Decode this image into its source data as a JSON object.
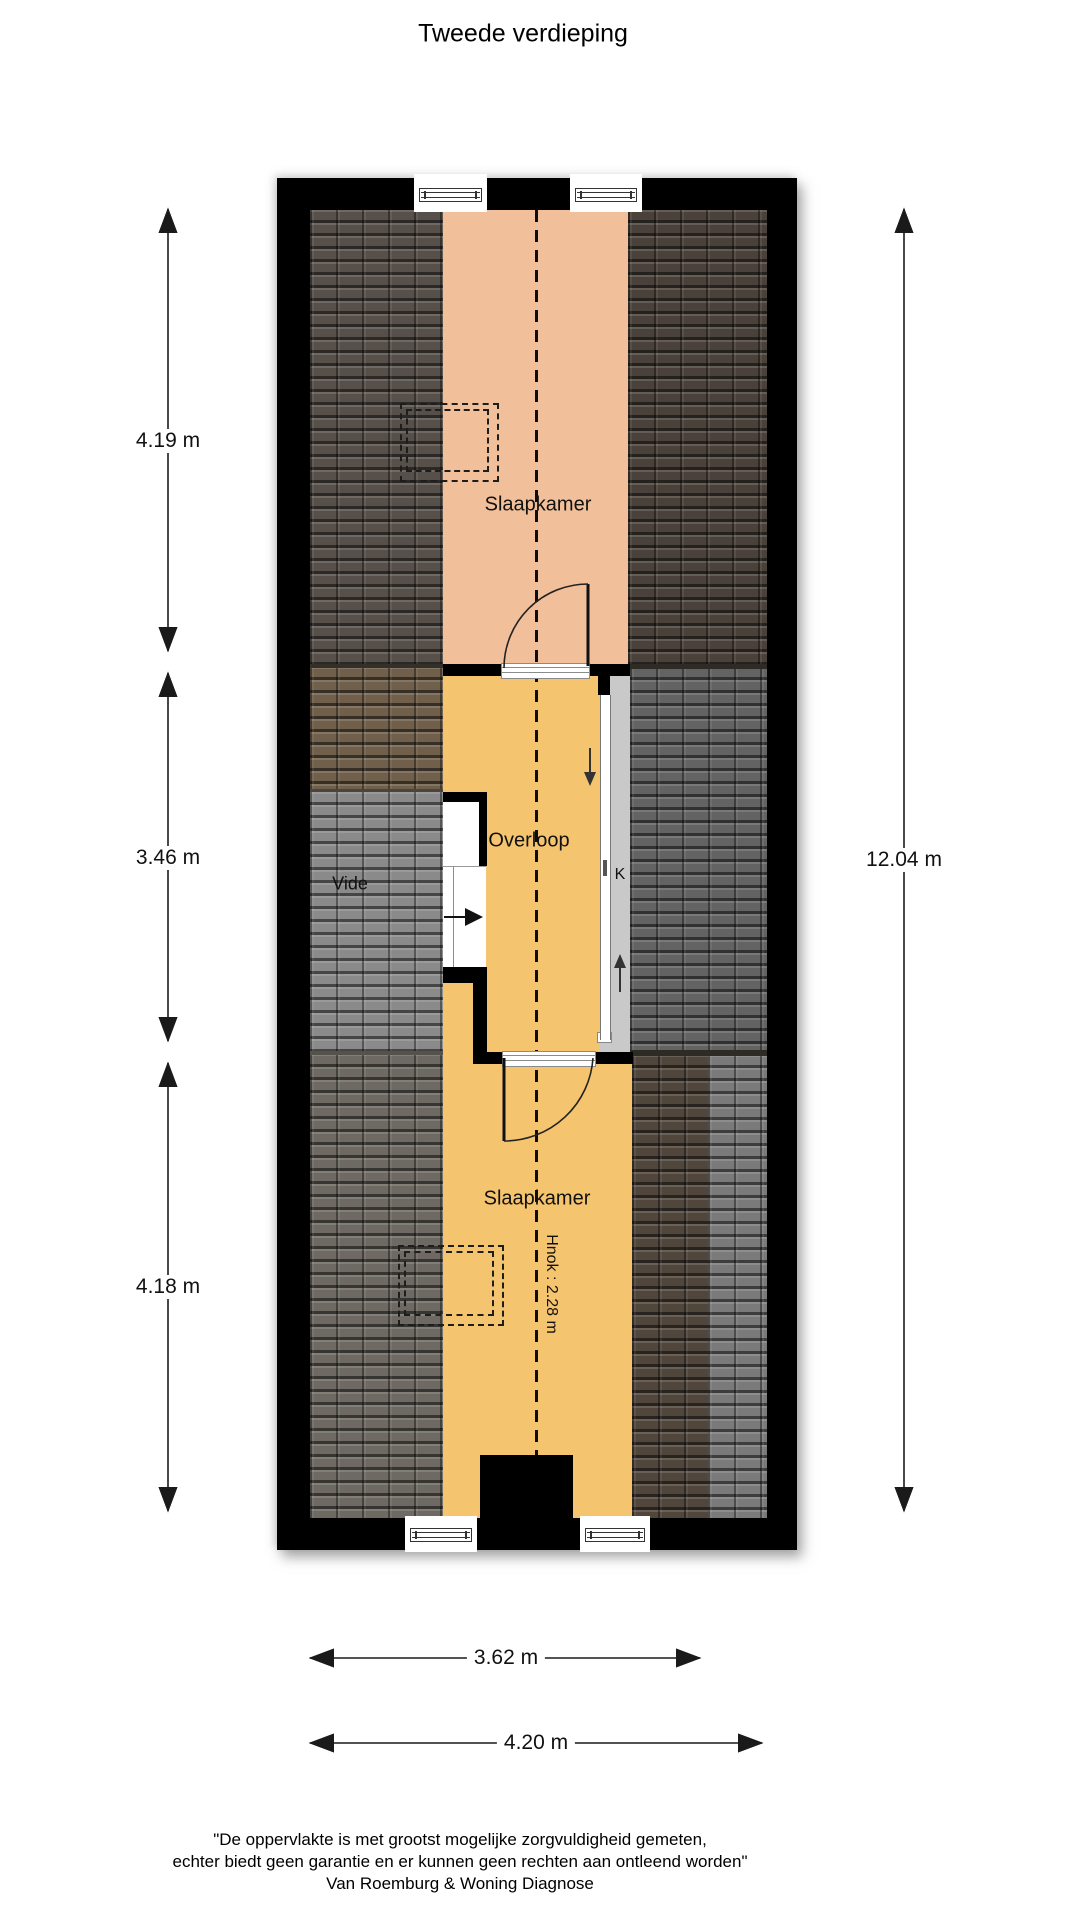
{
  "title": "Tweede verdieping",
  "rooms": {
    "bedroom_top": "Slaapkamer",
    "landing": "Overloop",
    "void": "Vide",
    "closet": "K",
    "bedroom_bottom": "Slaapkamer"
  },
  "annotations": {
    "ridge_height": "Hnok : 2.28 m"
  },
  "dimensions": {
    "left_top": "4.19 m",
    "left_middle": "3.46 m",
    "left_bottom": "4.18 m",
    "right_total": "12.04 m",
    "bottom_inner": "3.62 m",
    "bottom_outer": "4.20 m"
  },
  "disclaimer": {
    "line1": "\"De oppervlakte is met grootst mogelijke zorgvuldigheid gemeten,",
    "line2": "echter biedt geen garantie en er kunnen geen rechten aan ontleend worden\"",
    "line3": "Van Roemburg & Woning Diagnose"
  },
  "colors": {
    "wall": "#000000",
    "bedroom_top_floor": "#f1bf99",
    "landing_floor": "#f5c46e",
    "roof_dark_taupe": "#57504a",
    "roof_dark_brown": "#4a423a",
    "roof_mid_brown": "#6f5f4b",
    "roof_light_gray": "#8a8a8a",
    "roof_mid_gray": "#636363",
    "roof_bottom_left_gray": "#6e6a63",
    "roof_bottom_brown": "#50463c",
    "roof_bottom_gray_strip": "#7a7a7a",
    "closet_fill": "#c9c9c9"
  }
}
